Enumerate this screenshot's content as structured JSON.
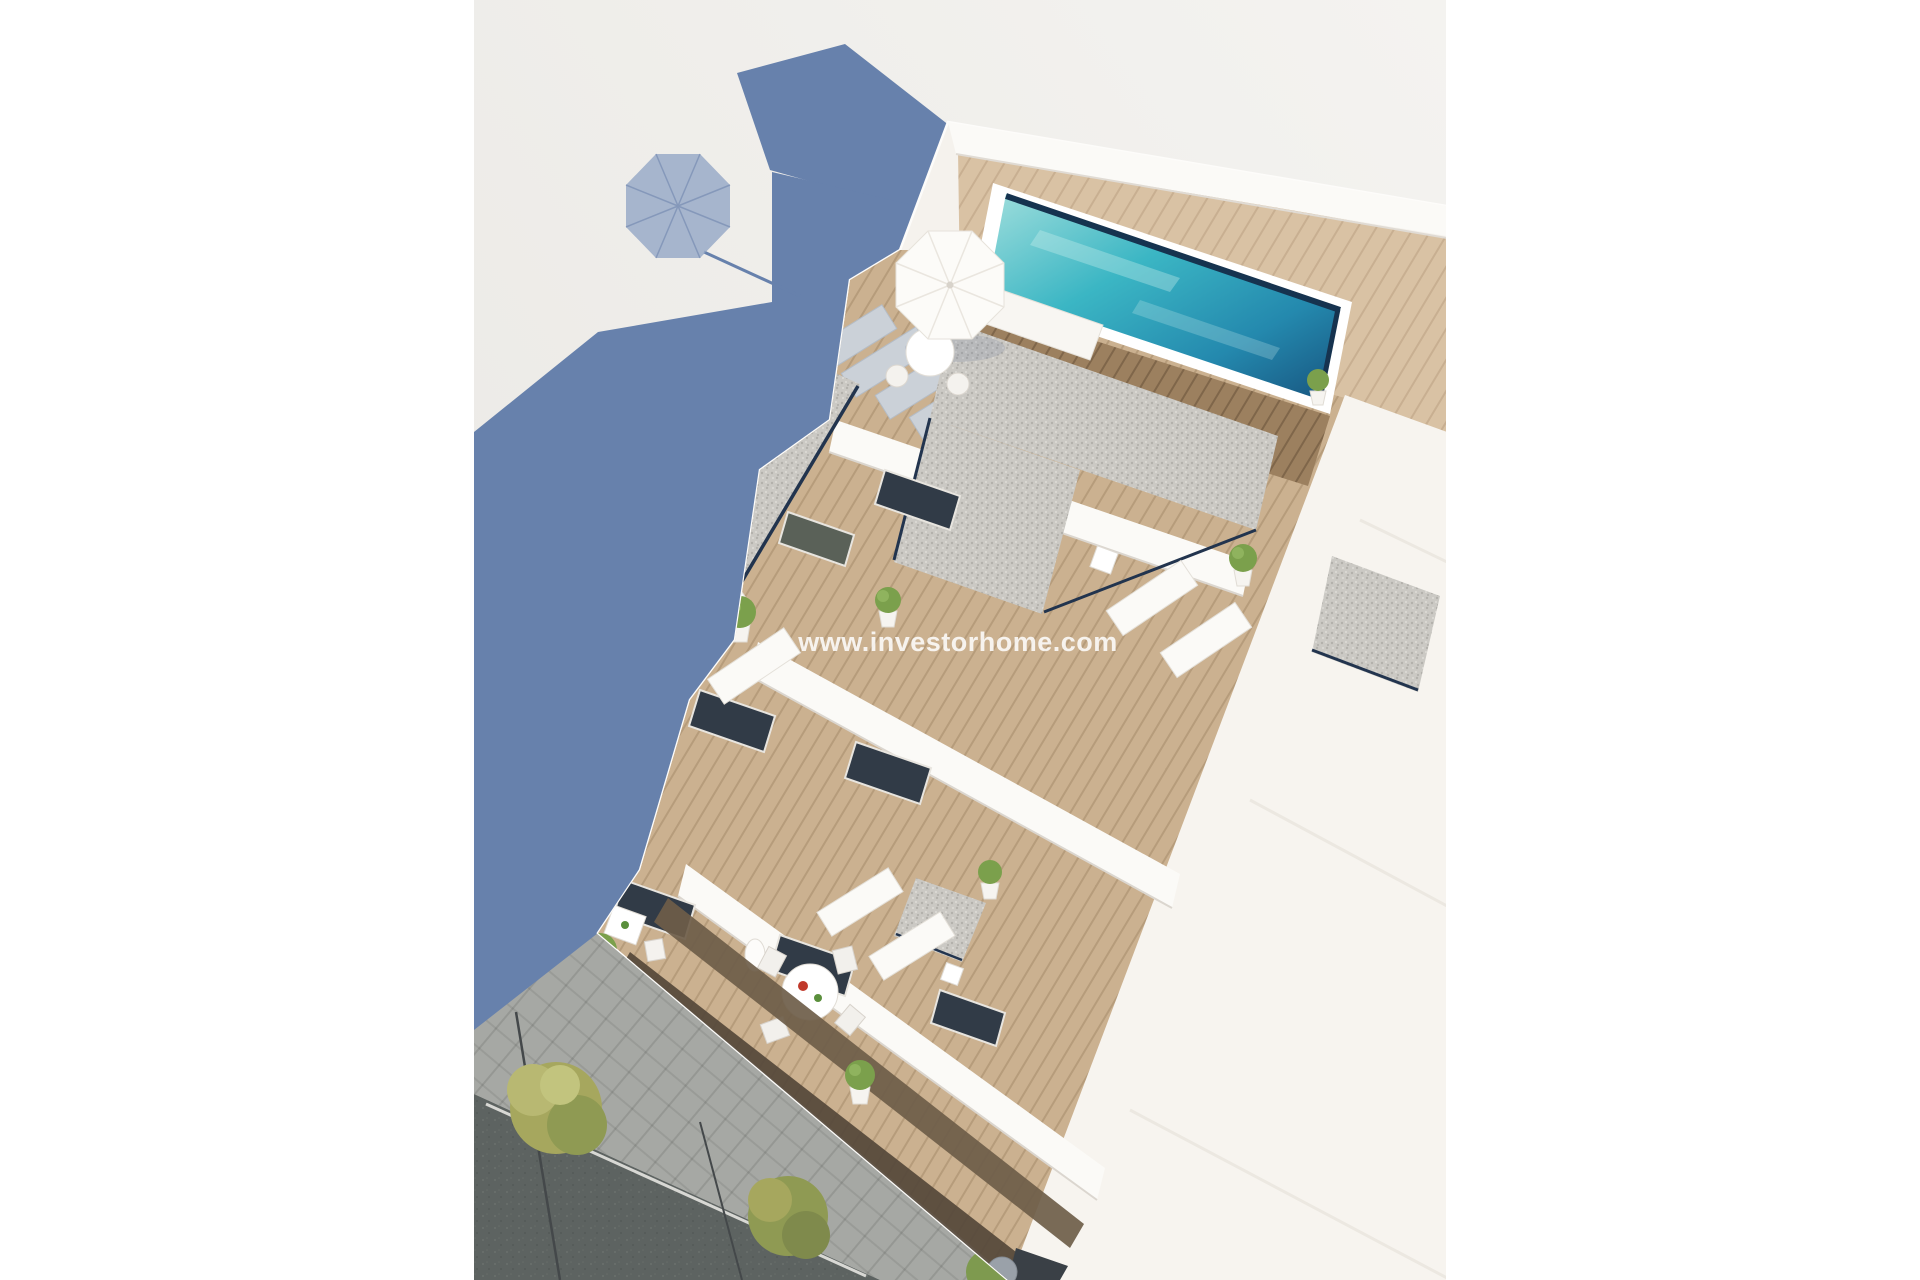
{
  "watermark": {
    "text": "www.investorhome.com",
    "color": "#FFFFFF"
  },
  "palette": {
    "page_white": "#FFFFFF",
    "bg_light": "#F4F3F0",
    "bg_dark": "#E9E7E3",
    "shadow_blue": "#6781AC",
    "shadow_blue_light": "#93A6C5",
    "building_white": "#F5F2ED",
    "parapet_white": "#FBFAF7",
    "wall_cream": "#F7F4EF",
    "wood_light": "#D9C2A4",
    "wood_mid": "#CBB190",
    "wood_dark": "#9C805F",
    "gravel_gray": "#CBC9C4",
    "pool_aqua_light": "#9FDEDC",
    "pool_aqua": "#3BB6C4",
    "pool_blue": "#2489AE",
    "pool_deep": "#17537E",
    "pool_rim": "#16334F",
    "sidewalk_gray": "#A6A8A4",
    "asphalt_gray": "#5D6361",
    "tree_yellow": "#A6A75E",
    "tree_olive": "#8F9A53",
    "plant_green": "#7BA04C",
    "furniture_white": "#FBFAF7",
    "door_dark": "#313B47"
  }
}
